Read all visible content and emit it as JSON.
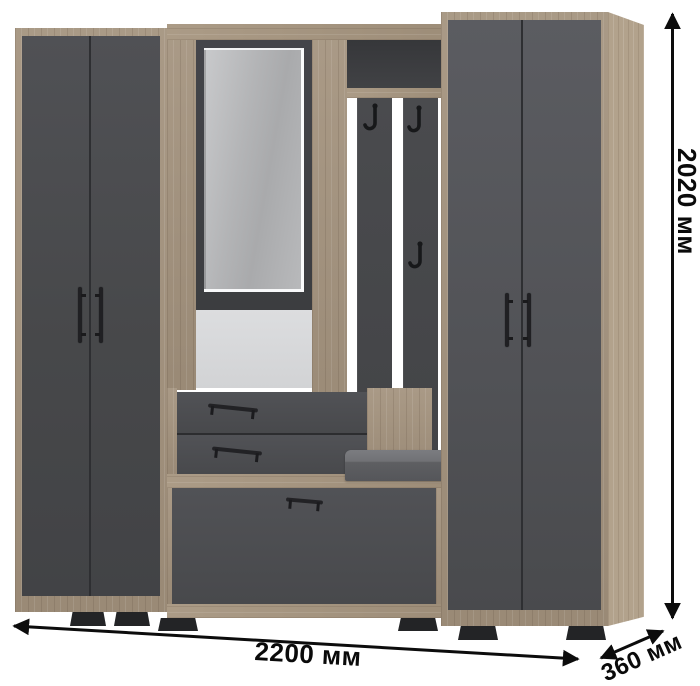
{
  "page": {
    "type": "furniture-dimension-render",
    "background": "#ffffff"
  },
  "dimension_labels": {
    "height": "2020 мм",
    "width": "2200 мм",
    "depth": "360 мм"
  },
  "palette": {
    "wood": "#a3927d",
    "wood_side": "#b2a28c",
    "door_gray_left": "#47484a",
    "door_gray_right": "#515256",
    "slat_gray": "#46474a",
    "mirror_gray": "#b3b4b6",
    "open_back_light": "#d6d7d8",
    "cubby_back_dark": "#3c3d40",
    "cushion_gray": "#6b6c70",
    "hardware_black": "#1b1b1e",
    "annotation": "#0c0c0c"
  },
  "furniture": {
    "description_visible": "hallway set: two tall wardrobes, mirror, coat hooks, two small drawers, bench with cushion, large bottom drawer",
    "coat_hooks_count": 3,
    "small_drawers_count": 2,
    "tall_wardrobes_count": 2
  }
}
